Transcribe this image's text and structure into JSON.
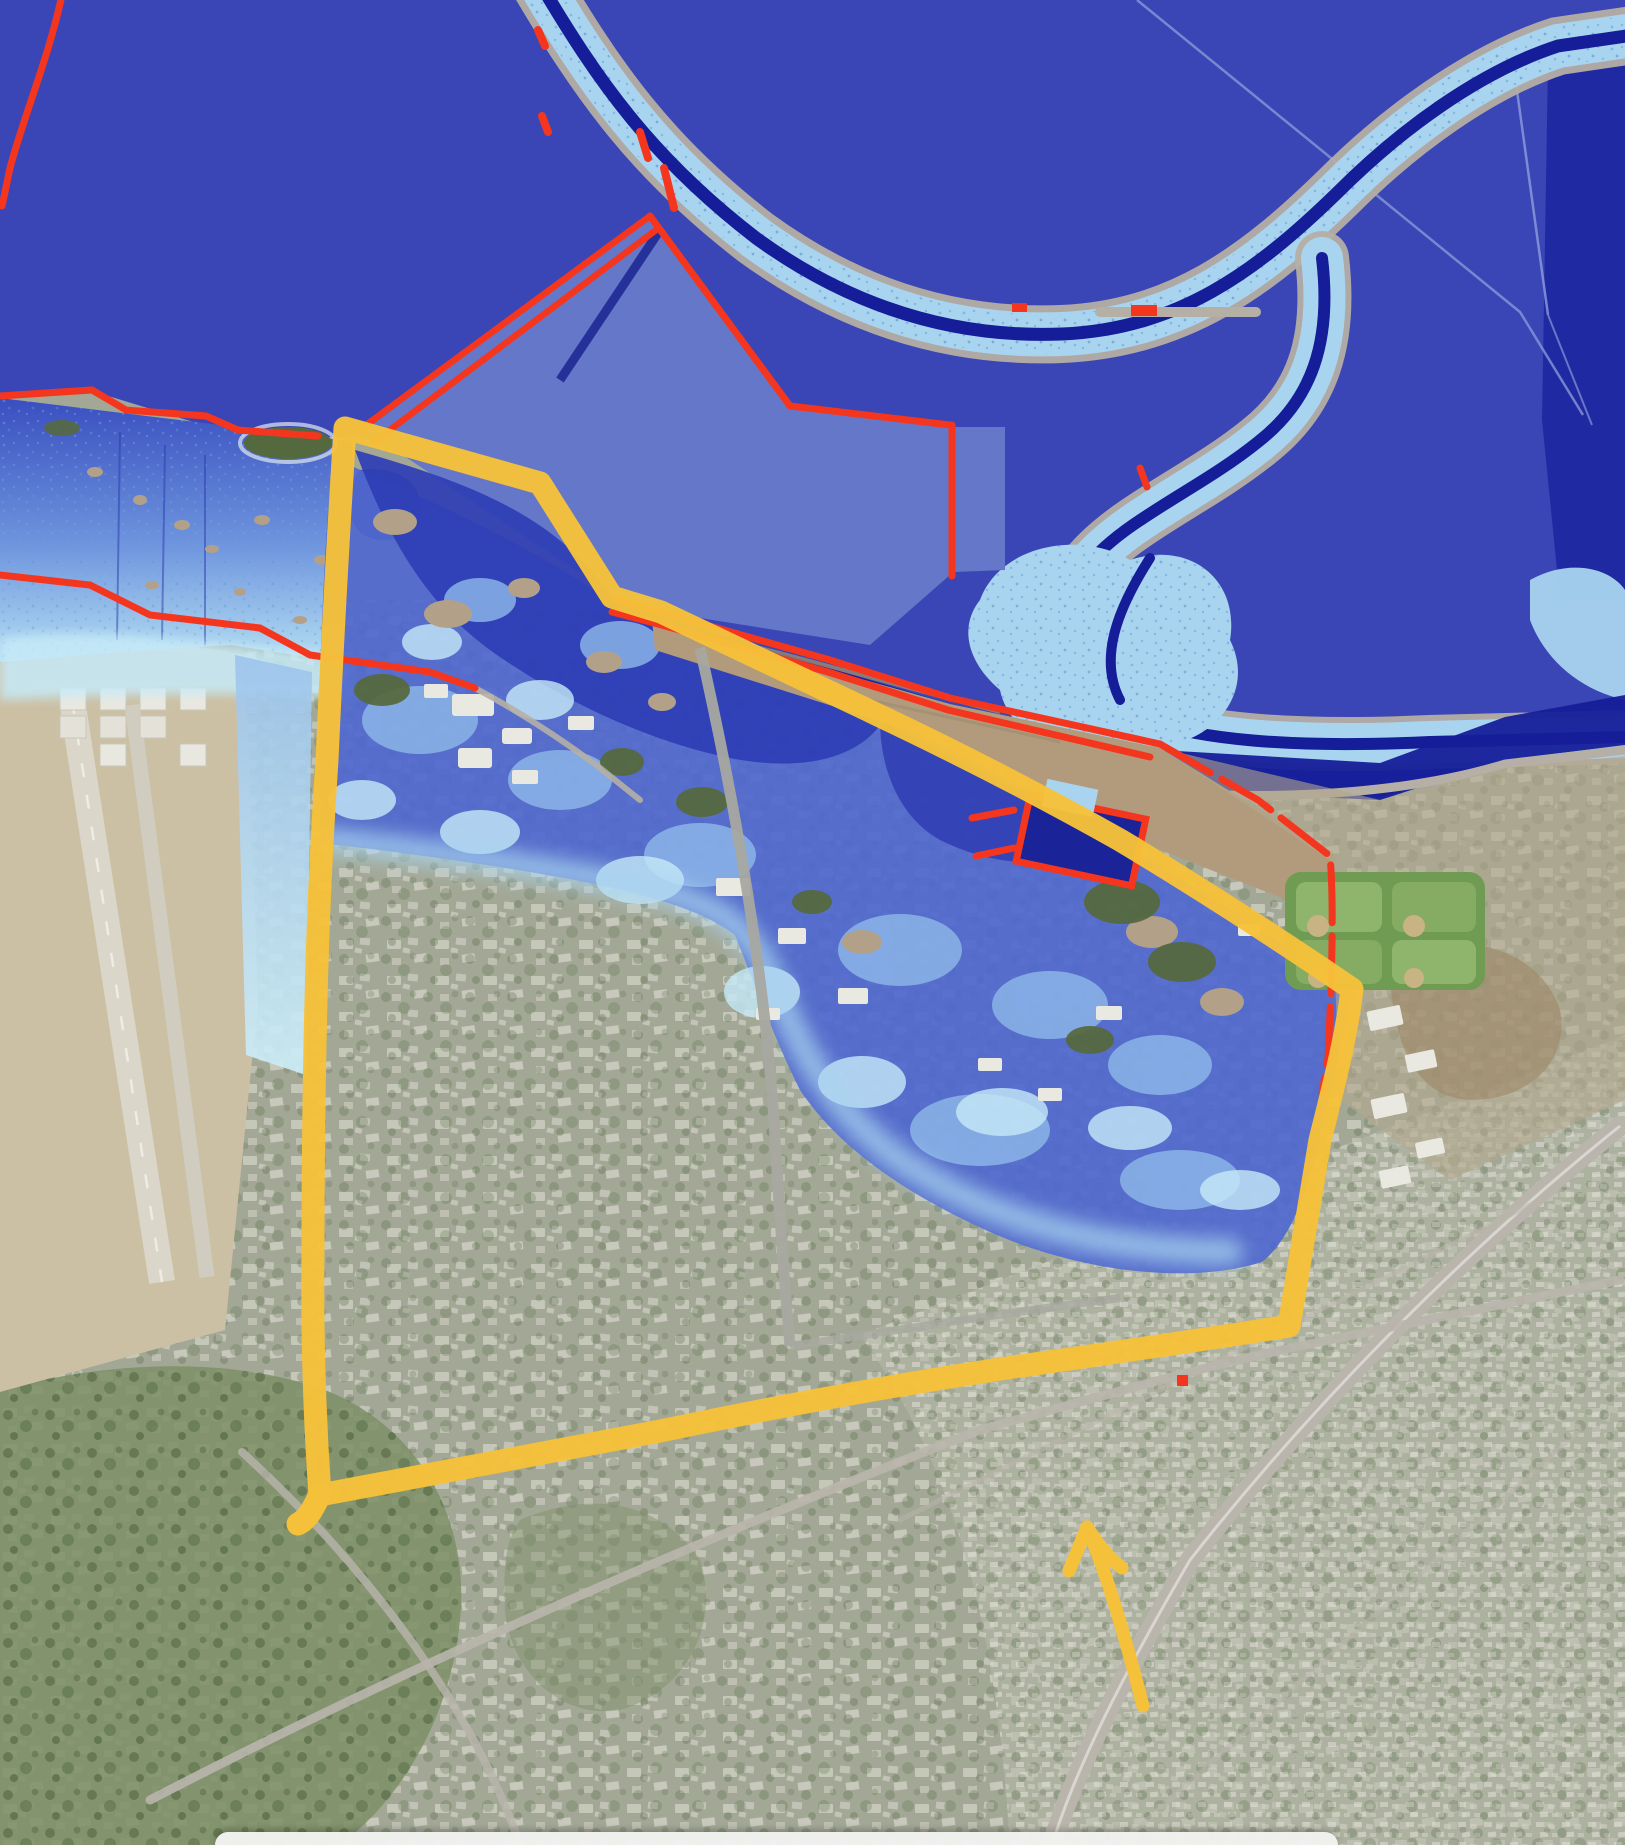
{
  "window": {
    "width": 1625,
    "height": 1845
  },
  "map": {
    "type": "satellite-flood-overlay-map",
    "features": [
      {
        "name": "bay-water",
        "color": "#3A46B5"
      },
      {
        "name": "salt-pond",
        "color": "#6577C8"
      },
      {
        "name": "deep-pond",
        "color": "#1F2AA2"
      },
      {
        "name": "slough-channel",
        "color": "#151D99"
      },
      {
        "name": "tidal-marsh",
        "color": "#A9D4EF"
      },
      {
        "name": "levee-line",
        "color": "#F5361F"
      },
      {
        "name": "levee-bank",
        "color": "#B5AFA5"
      },
      {
        "name": "flood-deep",
        "color": "#2E3EB5"
      },
      {
        "name": "flood-medium",
        "color": "#4F68CF"
      },
      {
        "name": "flood-shallow",
        "color": "#C6EAF8"
      },
      {
        "name": "coast-flats",
        "color": "#B29B7D"
      },
      {
        "name": "airfield",
        "color": "#CCC0A4"
      },
      {
        "name": "ballfields",
        "color": "#6F9C52"
      },
      {
        "name": "urban-area",
        "color": "#A3A896"
      }
    ],
    "annotation": {
      "polygon": {
        "color": "#F6C13A",
        "stroke_width": 23
      },
      "arrow": {
        "color": "#F6C13A",
        "stroke_width": 13
      }
    }
  },
  "colors": {
    "bay_deep": "#3A46B5",
    "pond_medium": "#6577C8",
    "pond_dark": "#1F2AA2",
    "channel_navy": "#151D99",
    "marsh_light": "#A9D4EF",
    "marsh_speckle": "#6EA6D8",
    "levee_gray": "#B5AFA5",
    "levee_red": "#F5361F",
    "flood_deep": "#2E3EB5",
    "flood_medium": "#4F68CF",
    "flood_light": "#8FB9EA",
    "flood_shallow": "#C6EAF8",
    "annotation_yellow": "#F6C13A",
    "coast_tan": "#B29B7D",
    "runway_tan": "#CCC0A4",
    "ballfield_green": "#6F9C52",
    "urban_base": "#A3A896",
    "urban_light": "#E9E8E1",
    "veg_green": "#55693F",
    "road_gray": "#B9B5AC",
    "bottom_sheet_bg": "#F2F3F0"
  },
  "bottom_sheet": {
    "background": "#F2F3F0"
  }
}
